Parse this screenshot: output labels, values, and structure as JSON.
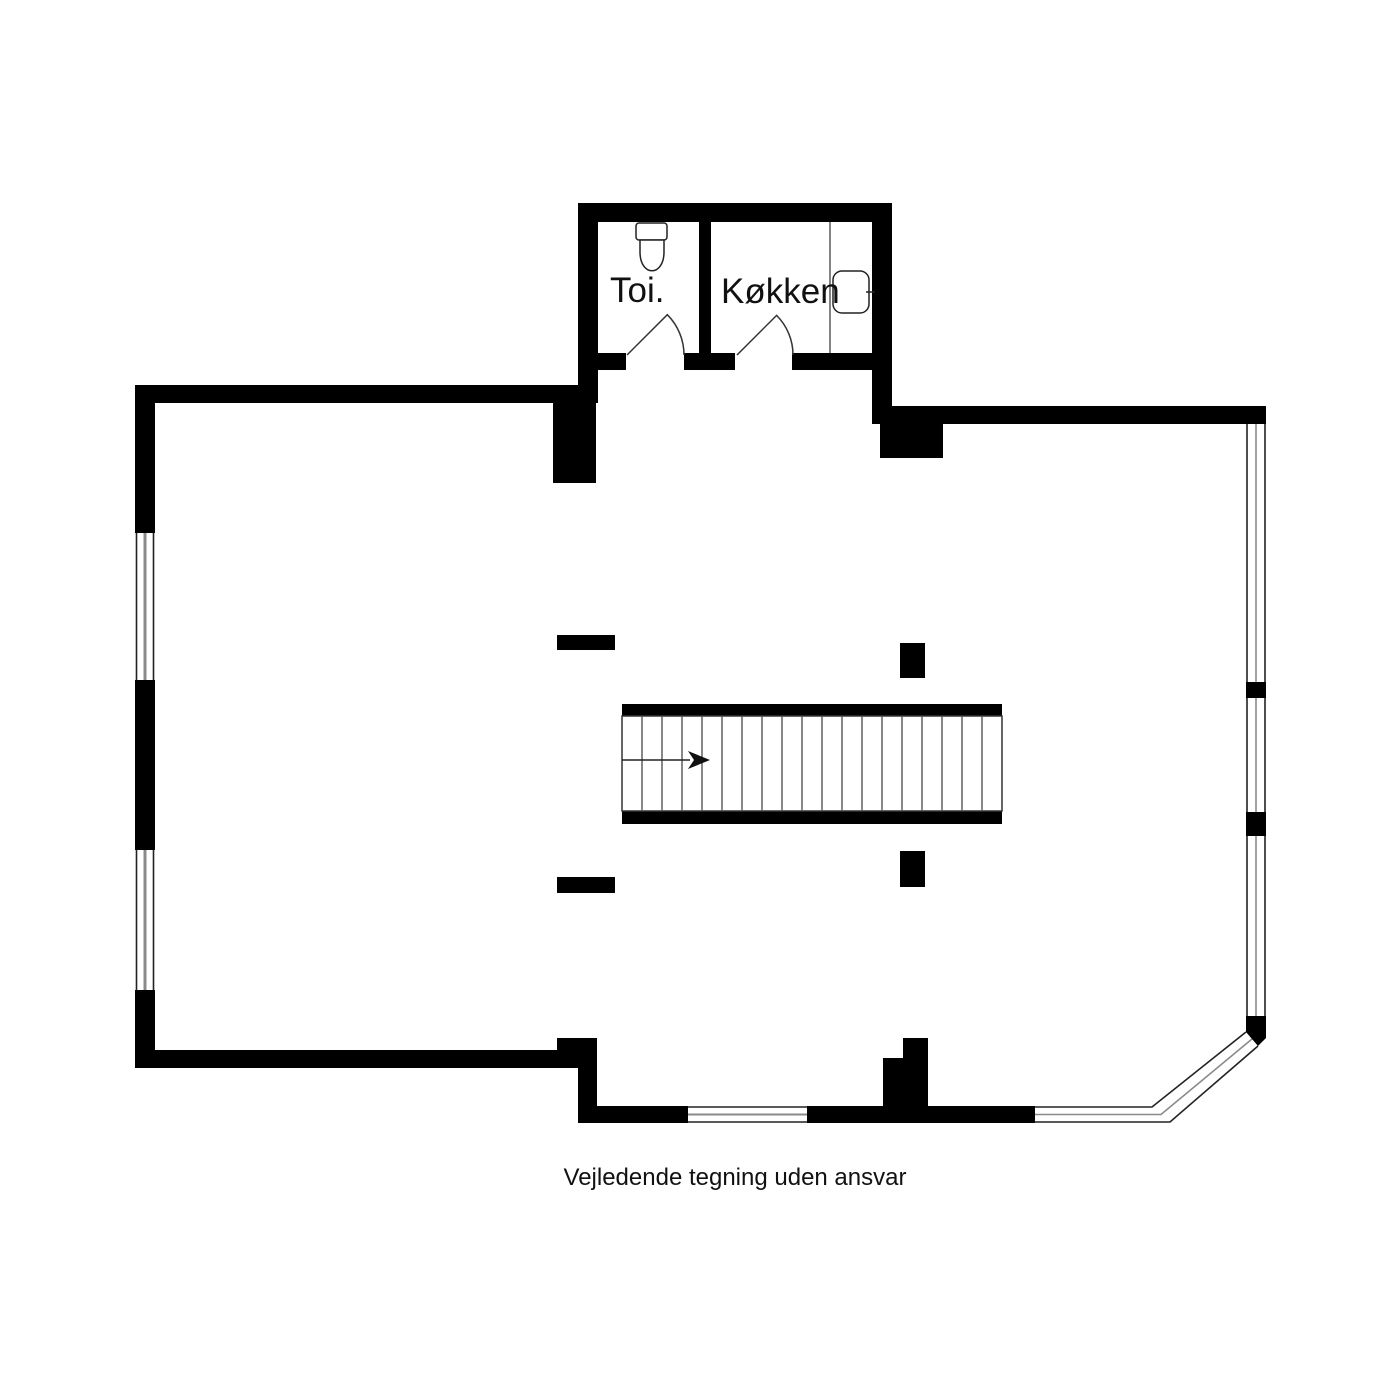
{
  "plan": {
    "disclaimer": "Vejledende tegning uden ansvar",
    "rooms": [
      {
        "id": "toilet",
        "label": "Toi."
      },
      {
        "id": "kitchen",
        "label": "Køkken"
      }
    ],
    "stairs": {
      "visible_steps": 18,
      "direction_arrow": "right"
    },
    "fixtures": [
      "toilet-icon",
      "kitchen-sink-icon",
      "kitchen-counter-line"
    ],
    "colors": {
      "wall": "#000000",
      "background": "#ffffff",
      "linework": "#222222",
      "window_mid_line": "#888888"
    }
  }
}
